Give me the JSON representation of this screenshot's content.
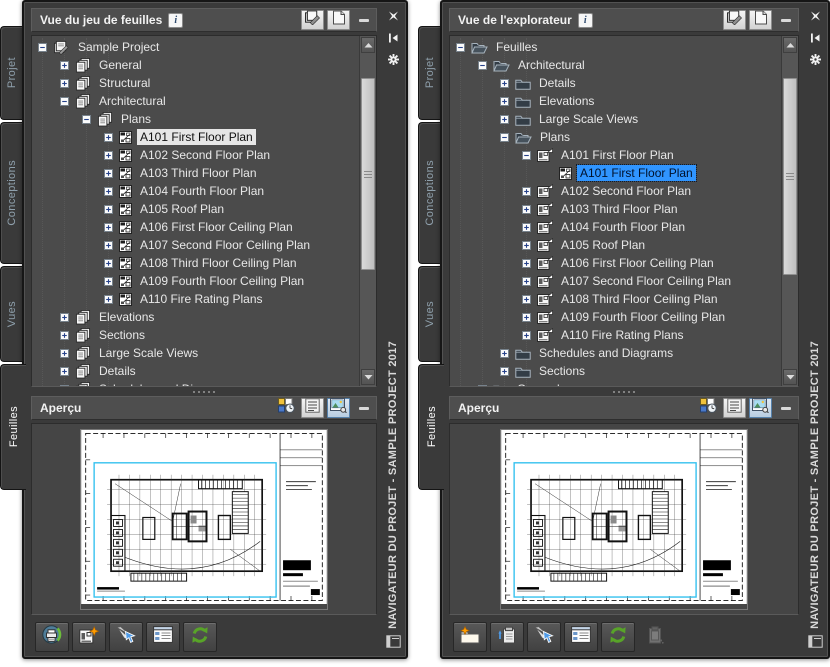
{
  "colors": {
    "selection_blue": "#3095ff",
    "selection_light": "#e6e6e6",
    "refresh_green": "#58a428",
    "viewport_cyan": "#35c1ef",
    "panel_background": "#3a3a3a",
    "tree_background": "#4b4b4b"
  },
  "left_panel": {
    "title": "Vue du jeu de feuilles",
    "info_badge": "i",
    "active_tab": "Feuilles",
    "tabs": [
      {
        "label": "Projet"
      },
      {
        "label": "Conceptions"
      },
      {
        "label": "Vues"
      },
      {
        "label": "Feuilles"
      }
    ],
    "titlebar_icons": [
      "sheets",
      "page"
    ],
    "window_buttons": [
      "close",
      "auto-hide",
      "settings"
    ],
    "side_title": "NAVIGATEUR DU PROJET - SAMPLE PROJECT 2017",
    "tree": [
      {
        "level": 0,
        "expander": "minus",
        "icon": "sheet-set",
        "label": "Sample Project"
      },
      {
        "level": 1,
        "expander": "plus",
        "icon": "subset",
        "label": "General"
      },
      {
        "level": 1,
        "expander": "plus",
        "icon": "subset",
        "label": "Structural"
      },
      {
        "level": 1,
        "expander": "minus",
        "icon": "subset",
        "label": "Architectural"
      },
      {
        "level": 2,
        "expander": "minus",
        "icon": "subset",
        "label": "Plans"
      },
      {
        "level": 3,
        "expander": "plus",
        "icon": "sheet",
        "label": "A101 First Floor Plan",
        "selected": "light"
      },
      {
        "level": 3,
        "expander": "plus",
        "icon": "sheet",
        "label": "A102 Second Floor Plan"
      },
      {
        "level": 3,
        "expander": "plus",
        "icon": "sheet",
        "label": "A103 Third Floor Plan"
      },
      {
        "level": 3,
        "expander": "plus",
        "icon": "sheet",
        "label": "A104 Fourth Floor Plan"
      },
      {
        "level": 3,
        "expander": "plus",
        "icon": "sheet",
        "label": "A105 Roof Plan"
      },
      {
        "level": 3,
        "expander": "plus",
        "icon": "sheet",
        "label": "A106 First Floor Ceiling Plan"
      },
      {
        "level": 3,
        "expander": "plus",
        "icon": "sheet",
        "label": "A107 Second Floor Ceiling Plan"
      },
      {
        "level": 3,
        "expander": "plus",
        "icon": "sheet",
        "label": "A108 Third Floor Ceiling Plan"
      },
      {
        "level": 3,
        "expander": "plus",
        "icon": "sheet",
        "label": "A109 Fourth Floor Ceiling Plan"
      },
      {
        "level": 3,
        "expander": "plus",
        "icon": "sheet",
        "label": "A110 Fire Rating Plans"
      },
      {
        "level": 1,
        "expander": "plus",
        "icon": "subset",
        "label": "Elevations"
      },
      {
        "level": 1,
        "expander": "plus",
        "icon": "subset",
        "label": "Sections"
      },
      {
        "level": 1,
        "expander": "plus",
        "icon": "subset",
        "label": "Large Scale Views"
      },
      {
        "level": 1,
        "expander": "plus",
        "icon": "subset",
        "label": "Details"
      },
      {
        "level": 1,
        "expander": "plus",
        "icon": "subset",
        "label": "Schedules and Diagrams"
      }
    ],
    "preview": {
      "title": "Aperçu",
      "buttons": [
        "details",
        "list",
        "image"
      ],
      "selected_button": "image"
    },
    "toolbar": [
      "publish",
      "new-sheet",
      "rename",
      "details-view",
      "refresh"
    ]
  },
  "right_panel": {
    "title": "Vue de l'explorateur",
    "info_badge": "i",
    "active_tab": "Feuilles",
    "tabs": [
      {
        "label": "Projet"
      },
      {
        "label": "Conceptions"
      },
      {
        "label": "Vues"
      },
      {
        "label": "Feuilles"
      }
    ],
    "titlebar_icons": [
      "sheets",
      "page"
    ],
    "window_buttons": [
      "close",
      "auto-hide",
      "settings"
    ],
    "side_title": "NAVIGATEUR DU PROJET - SAMPLE PROJECT 2017",
    "tree": [
      {
        "level": 0,
        "expander": "minus",
        "icon": "folder-open",
        "label": "Feuilles"
      },
      {
        "level": 1,
        "expander": "minus",
        "icon": "folder-open",
        "label": "Architectural"
      },
      {
        "level": 2,
        "expander": "plus",
        "icon": "folder-closed",
        "label": "Details"
      },
      {
        "level": 2,
        "expander": "plus",
        "icon": "folder-closed",
        "label": "Elevations"
      },
      {
        "level": 2,
        "expander": "plus",
        "icon": "folder-closed",
        "label": "Large Scale Views"
      },
      {
        "level": 2,
        "expander": "minus",
        "icon": "folder-open",
        "label": "Plans"
      },
      {
        "level": 3,
        "expander": "minus",
        "icon": "layout",
        "label": "A101 First Floor Plan"
      },
      {
        "level": 4,
        "expander": null,
        "icon": "sheet",
        "label": "A101 First Floor Plan",
        "selected": "blue"
      },
      {
        "level": 3,
        "expander": "plus",
        "icon": "layout",
        "label": "A102 Second Floor Plan"
      },
      {
        "level": 3,
        "expander": "plus",
        "icon": "layout",
        "label": "A103 Third Floor Plan"
      },
      {
        "level": 3,
        "expander": "plus",
        "icon": "layout",
        "label": "A104 Fourth Floor Plan"
      },
      {
        "level": 3,
        "expander": "plus",
        "icon": "layout",
        "label": "A105 Roof Plan"
      },
      {
        "level": 3,
        "expander": "plus",
        "icon": "layout",
        "label": "A106 First Floor Ceiling Plan"
      },
      {
        "level": 3,
        "expander": "plus",
        "icon": "layout",
        "label": "A107 Second Floor Ceiling Plan"
      },
      {
        "level": 3,
        "expander": "plus",
        "icon": "layout",
        "label": "A108 Third Floor Ceiling Plan"
      },
      {
        "level": 3,
        "expander": "plus",
        "icon": "layout",
        "label": "A109 Fourth Floor Ceiling Plan"
      },
      {
        "level": 3,
        "expander": "plus",
        "icon": "layout",
        "label": "A110 Fire Rating Plans"
      },
      {
        "level": 2,
        "expander": "plus",
        "icon": "folder-closed",
        "label": "Schedules and Diagrams"
      },
      {
        "level": 2,
        "expander": "plus",
        "icon": "folder-closed",
        "label": "Sections"
      },
      {
        "level": 1,
        "expander": "plus",
        "icon": "folder-closed",
        "label": "General"
      }
    ],
    "preview": {
      "title": "Aperçu",
      "buttons": [
        "details",
        "list",
        "image"
      ],
      "selected_button": "image"
    },
    "toolbar": [
      "new-folder",
      "import-layout",
      "rename",
      "details-view",
      "refresh",
      "paste-disabled"
    ]
  }
}
